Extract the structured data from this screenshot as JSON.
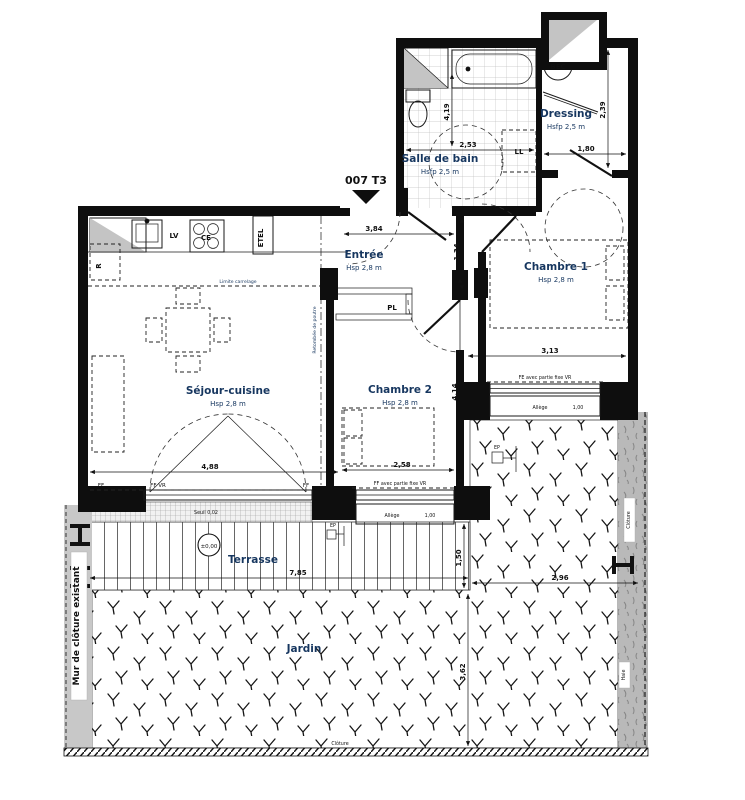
{
  "title": {
    "unit": "007 T3"
  },
  "labels": {
    "sejour_name": "Séjour-cuisine",
    "sejour_h": "Hsp 2,8 m",
    "entree_name": "Entrée",
    "entree_h": "Hsp 2,8 m",
    "ch1_name": "Chambre 1",
    "ch1_h": "Hsp 2,8 m",
    "ch2_name": "Chambre 2",
    "ch2_h": "Hsp 2,8 m",
    "sdb_name": "Salle de bain",
    "sdb_h": "Hsfp 2,5 m",
    "dressing_name": "Dressing",
    "dressing_h": "Hsfp 2,5 m",
    "terrasse": "Terrasse",
    "jardin": "Jardin"
  },
  "equip": {
    "lv": "LV",
    "ce": "CE",
    "etel": "ETEL",
    "r": "R",
    "pl": "PL",
    "ll": "LL",
    "bec": "BEC",
    "ep1": "EP",
    "ep2": "EP"
  },
  "annot": {
    "limite": "Limite carrelage",
    "retombee": "Retombée de poutre",
    "seuil": "Seuil 0,02",
    "niveau": "±0,00",
    "ff1": "FF",
    "ff2": "FF  VR",
    "ff3": "FF",
    "ff_fixe": "FF avec partie fixe  VR",
    "fe_fixe": "FE avec partie fixe  VR",
    "allege1_l": "Allège",
    "allege1_v": "1,00",
    "allege2_l": "Allège",
    "allege2_v": "1,00",
    "mur": "Mur de clôture existant",
    "cloture_r": "Clôture",
    "cloture_b": "Clôture",
    "haie": "Haie"
  },
  "dims": {
    "d384": "3,84",
    "d134": "1,34",
    "d253": "2,53",
    "d419": "4,19",
    "d180": "1,80",
    "d239": "2,39",
    "d313": "3,13",
    "d414": "4,14",
    "d488": "4,88",
    "d258": "2,58",
    "d785": "7,85",
    "d150": "1,50",
    "d296": "2,96",
    "d362": "3,62"
  },
  "colors": {
    "wall": "#0e0e0e",
    "room_label": "#16365f",
    "hedge": "#b9b9b9",
    "mur_strip": "#c8c8c8"
  }
}
